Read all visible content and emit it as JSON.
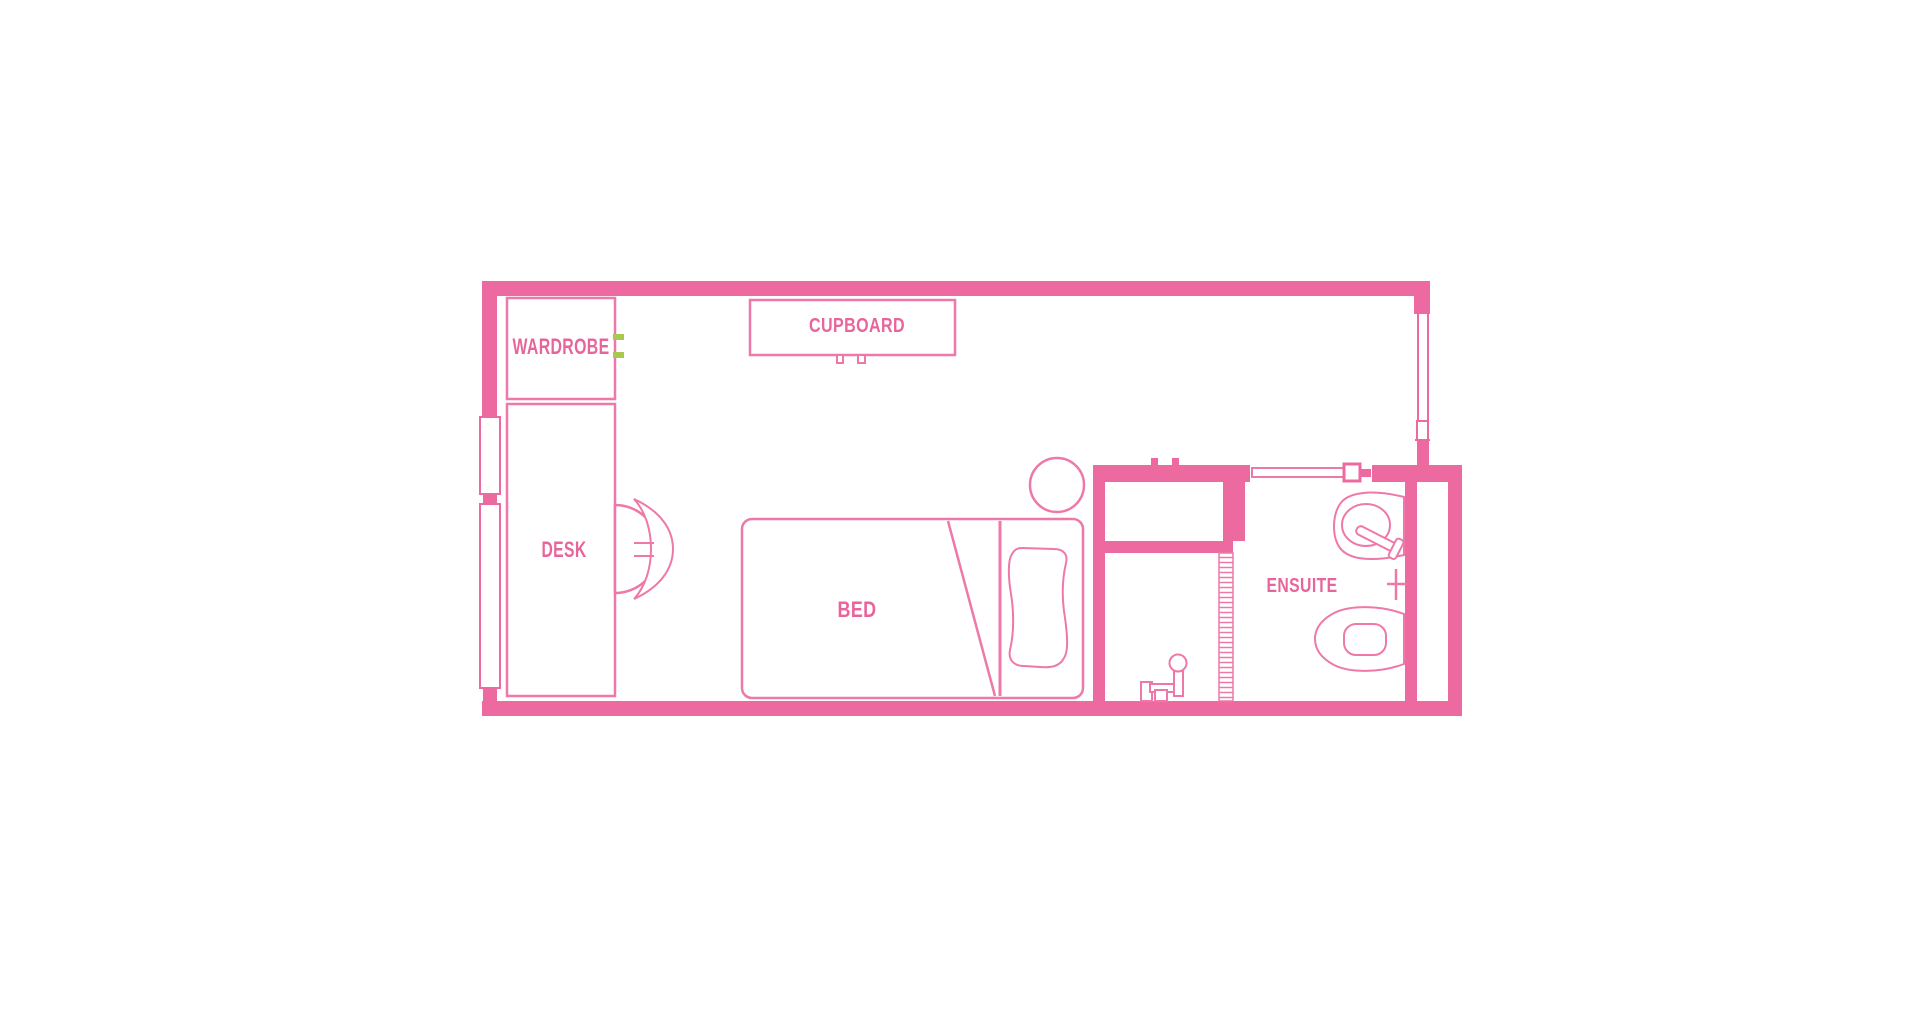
{
  "labels": {
    "wardrobe": "WARDROBE",
    "desk": "DESK",
    "cupboard": "CUPBOARD",
    "bed": "BED",
    "ensuite": "ENSUITE"
  },
  "colors": {
    "wall": "#ec6aa0",
    "line": "#ee79a9",
    "label": "#e8659c",
    "accent_green": "#a8c94e",
    "background": "#ffffff"
  }
}
